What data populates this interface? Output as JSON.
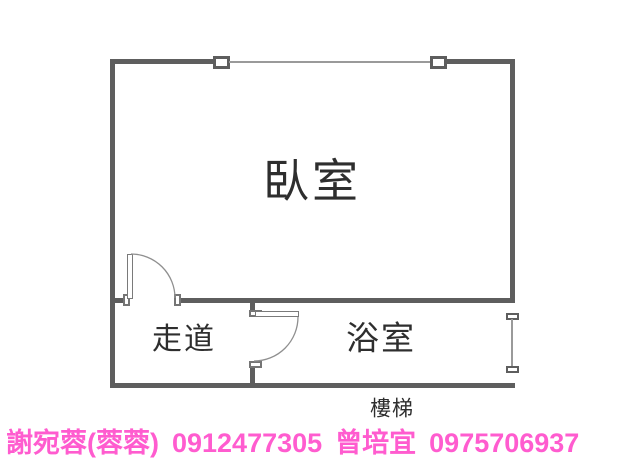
{
  "plan": {
    "rooms": [
      {
        "id": "bedroom",
        "label": "臥室"
      },
      {
        "id": "corridor",
        "label": "走道"
      },
      {
        "id": "bathroom",
        "label": "浴室"
      }
    ],
    "stairs_label": "樓梯",
    "features": [
      "window-top-wall",
      "window-bathroom-right-wall",
      "bedroom-swing-door",
      "bathroom-swing-door"
    ]
  },
  "contact": {
    "agent1_name": "謝宛蓉(蓉蓉)",
    "agent1_phone": "0912477305",
    "agent2_name": "曾培宜",
    "agent2_phone": "0975706937"
  },
  "colors": {
    "wall": "#5e5e5e",
    "window_line": "#9a9a9a",
    "label_text": "#2e2e2e",
    "contact_text": "#ff5ccf"
  }
}
